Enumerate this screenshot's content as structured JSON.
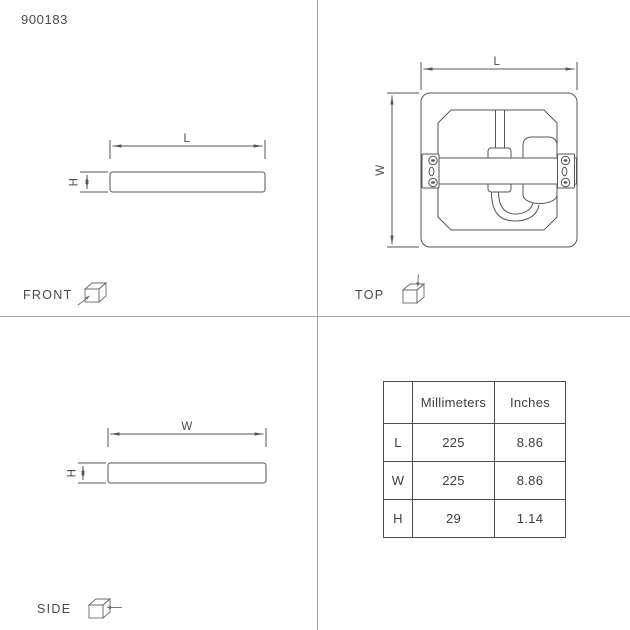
{
  "product": {
    "number": "900183"
  },
  "views": {
    "front": {
      "label": "FRONT",
      "dim_horizontal": "L",
      "dim_vertical": "H",
      "icon": "cube-front-view-icon"
    },
    "top": {
      "label": "TOP",
      "dim_horizontal": "L",
      "dim_vertical": "W",
      "icon": "cube-top-view-icon"
    },
    "side": {
      "label": "SIDE",
      "dim_horizontal": "W",
      "dim_vertical": "H",
      "icon": "cube-side-view-icon"
    }
  },
  "table": {
    "columns": [
      "",
      "Millimeters",
      "Inches"
    ],
    "rows": [
      {
        "label": "L",
        "millimeters": "225",
        "inches": "8.86"
      },
      {
        "label": "W",
        "millimeters": "225",
        "inches": "8.86"
      },
      {
        "label": "H",
        "millimeters": "29",
        "inches": "1.14"
      }
    ]
  },
  "colors": {
    "background": "#ffffff",
    "drawing_line": "#55555a",
    "divider": "#a6a6a6",
    "text": "#4a4a4e",
    "table_border": "#4c4c4c"
  }
}
